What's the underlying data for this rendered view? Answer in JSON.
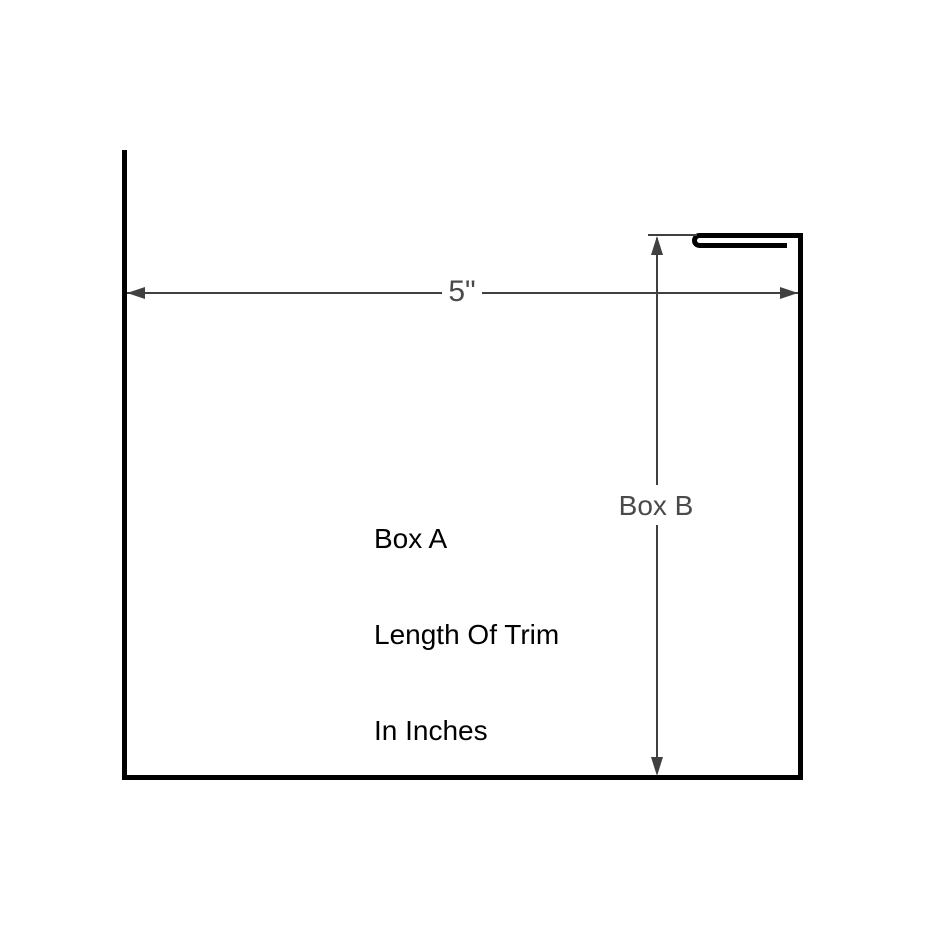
{
  "diagram": {
    "labels": {
      "box_a_line1": "Box A",
      "box_a_line2": "Length Of Trim",
      "box_a_line3": "In Inches",
      "box_b": "Box B",
      "width_dimension": "5\""
    },
    "colors": {
      "profile": "#000000",
      "dimension": "#404040",
      "dimension_text": "#4a4a4a",
      "text": "#000000",
      "background": "#ffffff"
    }
  }
}
